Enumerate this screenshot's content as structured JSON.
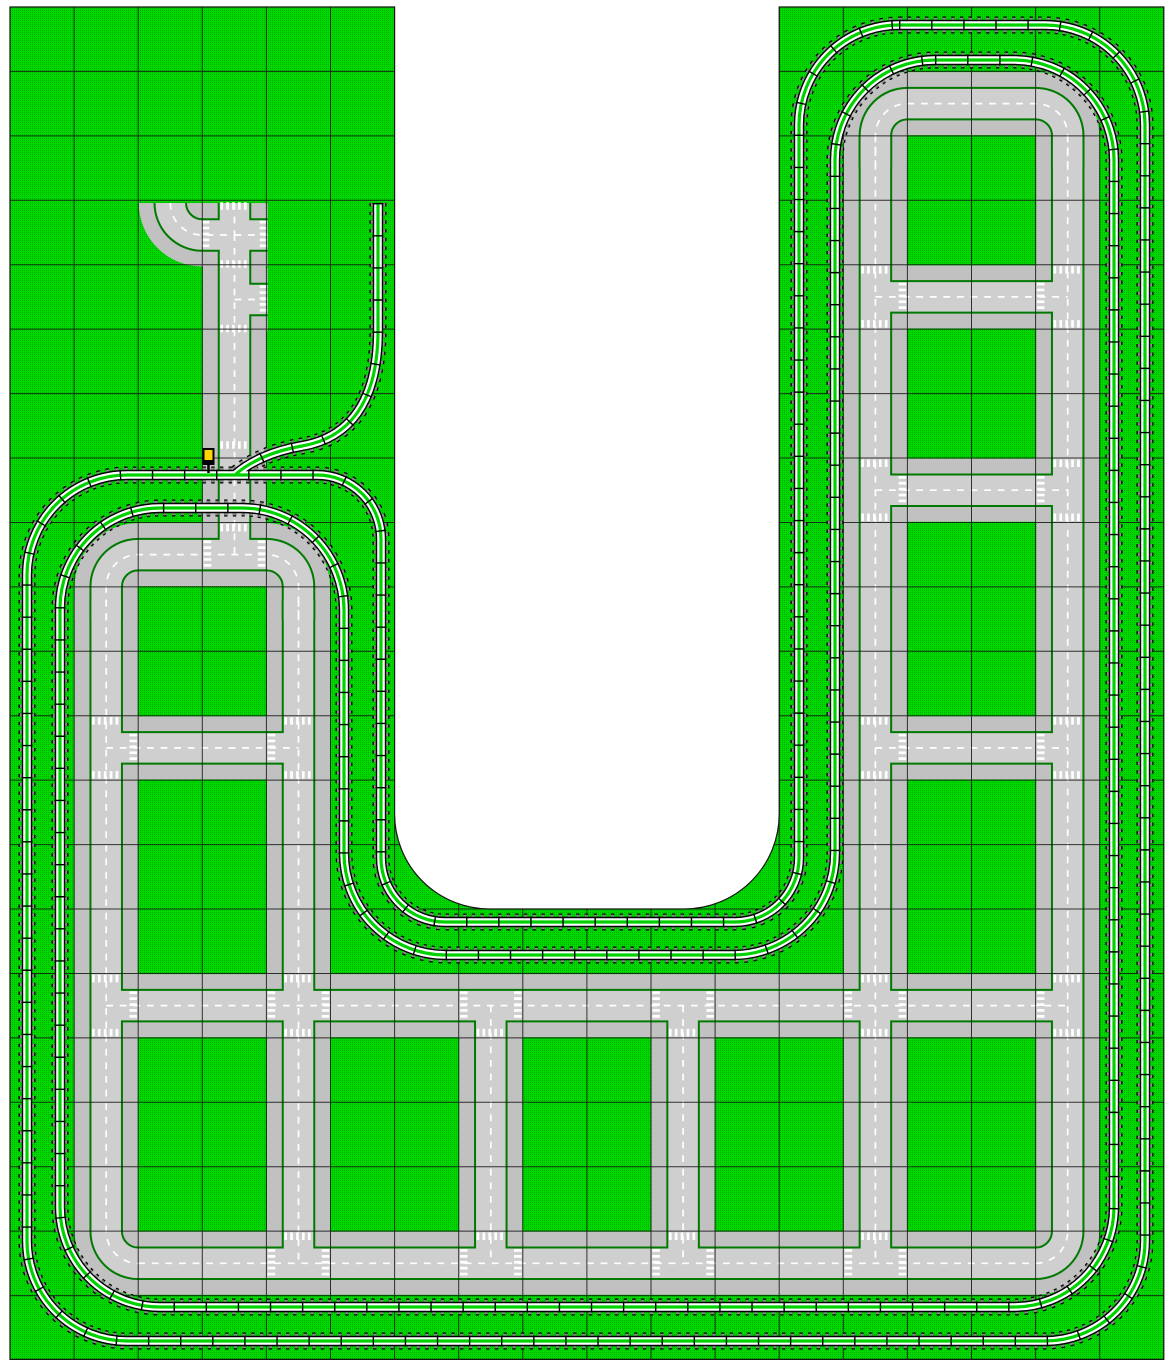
{
  "canvas": {
    "width": 1176,
    "height": 1368,
    "background": "#FFFFFF"
  },
  "layout": {
    "grid": {
      "x0": 10,
      "y0": 7,
      "cw": 64.1,
      "ch": 64.43,
      "cols": 18,
      "rows": 21,
      "color": "#151515"
    },
    "baseplates": {
      "color": "#00DA00",
      "stud_color": "#00B000",
      "edge_color": "#151515",
      "outline_path": "M10,7 H394.6 V814 A95 95 0 0 0 489.6,909 H684.2 A95 95 0 0 0 779.2,814 V7 H1163.8 V1359.4 H10 Z"
    },
    "roads": {
      "style": {
        "plate": {
          "c": "#C1C1C1",
          "w": 63
        },
        "curb": {
          "c": "#007A00",
          "w": 33.5
        },
        "asphalt": {
          "c": "#CFCFCF",
          "w": 29.5
        },
        "center": {
          "c": "#FFFFFF",
          "w": 1.7,
          "dash": "6.8 6.8"
        }
      },
      "segments": [
        {
          "name": "col3-street",
          "d": "M170.3,203 A32 32 0 0 0 202.3,235 H234.5 V554.6"
        },
        {
          "name": "col3-north-stub",
          "d": "M234.5,203 V235"
        },
        {
          "name": "col3-east-stub-1",
          "d": "M234.5,235 H267.6"
        },
        {
          "name": "col3-east-stub-2",
          "d": "M234.5,299.5 H267.6"
        },
        {
          "name": "left-ring-top",
          "d": "M106.2,620 V586.6 A32 32 0 0 1 138.2,554.6 H266.5 A32 32 0 0 1 298.5,586.6 V620"
        },
        {
          "name": "col1-avenue",
          "d": "M106.2,600 V1231.3 A32 32 0 0 0 138.2,1263.3"
        },
        {
          "name": "col4-avenue",
          "d": "M298.5,600 V1263.3"
        },
        {
          "name": "left-rung-11",
          "d": "M106.2,747.9 H298.5"
        },
        {
          "name": "main-street-15",
          "d": "M106.2,1005.6 H1067.7"
        },
        {
          "name": "south-street-19",
          "d": "M138.2,1263.3 H1035.7 A32 32 0 0 0 1067.7,1231.3"
        },
        {
          "name": "col7-connector",
          "d": "M490.8,1005.6 V1263.3"
        },
        {
          "name": "col10-connector",
          "d": "M683.1,1005.6 V1263.3"
        },
        {
          "name": "col13-avenue",
          "d": "M875.4,135.7 V1263.3"
        },
        {
          "name": "col16-avenue",
          "d": "M1067.7,135.7 V1231.3"
        },
        {
          "name": "right-ring-top",
          "d": "M875.4,167 V135.7 A32 32 0 0 1 907.4,103.6 H1035.7 A32 32 0 0 1 1067.7,135.7 V167"
        },
        {
          "name": "right-rung-4",
          "d": "M875.4,296.9 H1067.7"
        },
        {
          "name": "right-rung-7",
          "d": "M875.4,490.2 H1067.7"
        },
        {
          "name": "right-rung-11",
          "d": "M875.4,747.9 H1067.7"
        }
      ],
      "crosswalk_style": {
        "c": "#FFFFFF",
        "w": 7.5,
        "dash": "2.7 3.2",
        "half": 14.2
      },
      "crosswalks": [
        [
          234.5,
          206,
          "h"
        ],
        [
          263.5,
          235,
          "v"
        ],
        [
          234.5,
          264,
          "h"
        ],
        [
          205.5,
          235,
          "v"
        ],
        [
          263.5,
          299.5,
          "v"
        ],
        [
          234.5,
          328.5,
          "h"
        ],
        [
          234.5,
          445,
          "h"
        ],
        [
          234.5,
          527.6,
          "h"
        ],
        [
          207.5,
          554.6,
          "v"
        ],
        [
          261.5,
          554.6,
          "v"
        ],
        [
          106.2,
          720.9,
          "h"
        ],
        [
          106.2,
          774.9,
          "h"
        ],
        [
          133.2,
          747.9,
          "v"
        ],
        [
          298.5,
          720.9,
          "h"
        ],
        [
          298.5,
          774.9,
          "h"
        ],
        [
          271.5,
          747.9,
          "v"
        ],
        [
          106.2,
          978.6,
          "h"
        ],
        [
          106.2,
          1032.6,
          "h"
        ],
        [
          133.2,
          1005.6,
          "v"
        ],
        [
          298.5,
          978.6,
          "h"
        ],
        [
          298.5,
          1032.6,
          "h"
        ],
        [
          271.5,
          1005.6,
          "v"
        ],
        [
          325.5,
          1005.6,
          "v"
        ],
        [
          490.8,
          1032.6,
          "h"
        ],
        [
          463.8,
          1005.6,
          "v"
        ],
        [
          517.8,
          1005.6,
          "v"
        ],
        [
          683.1,
          1032.6,
          "h"
        ],
        [
          656.1,
          1005.6,
          "v"
        ],
        [
          710.1,
          1005.6,
          "v"
        ],
        [
          875.4,
          978.6,
          "h"
        ],
        [
          875.4,
          1032.6,
          "h"
        ],
        [
          848.4,
          1005.6,
          "v"
        ],
        [
          902.4,
          1005.6,
          "v"
        ],
        [
          1067.7,
          978.6,
          "h"
        ],
        [
          1067.7,
          1032.6,
          "h"
        ],
        [
          1040.7,
          1005.6,
          "v"
        ],
        [
          298.5,
          1236.3,
          "h"
        ],
        [
          271.5,
          1263.3,
          "v"
        ],
        [
          325.5,
          1263.3,
          "v"
        ],
        [
          490.8,
          1236.3,
          "h"
        ],
        [
          463.8,
          1263.3,
          "v"
        ],
        [
          517.8,
          1263.3,
          "v"
        ],
        [
          683.1,
          1236.3,
          "h"
        ],
        [
          656.1,
          1263.3,
          "v"
        ],
        [
          710.1,
          1263.3,
          "v"
        ],
        [
          875.4,
          1236.3,
          "h"
        ],
        [
          848.4,
          1263.3,
          "v"
        ],
        [
          902.4,
          1263.3,
          "v"
        ],
        [
          875.4,
          269.9,
          "h"
        ],
        [
          875.4,
          323.9,
          "h"
        ],
        [
          902.4,
          296.9,
          "v"
        ],
        [
          1067.7,
          269.9,
          "h"
        ],
        [
          1067.7,
          323.9,
          "h"
        ],
        [
          1040.7,
          296.9,
          "v"
        ],
        [
          875.4,
          463.2,
          "h"
        ],
        [
          875.4,
          517.2,
          "h"
        ],
        [
          902.4,
          490.2,
          "v"
        ],
        [
          1067.7,
          463.2,
          "h"
        ],
        [
          1067.7,
          517.2,
          "h"
        ],
        [
          1040.7,
          490.2,
          "v"
        ],
        [
          875.4,
          720.9,
          "h"
        ],
        [
          875.4,
          774.9,
          "h"
        ],
        [
          902.4,
          747.9,
          "v"
        ],
        [
          1067.7,
          720.9,
          "h"
        ],
        [
          1067.7,
          774.9,
          "h"
        ],
        [
          1040.7,
          747.9,
          "v"
        ]
      ]
    },
    "tracks": {
      "layers": [
        {
          "c": "#000000",
          "w": 17,
          "dash": "3.4 5.3"
        },
        {
          "c": "#8B8B8B",
          "w": 14.4,
          "dash": "3.4 5.3"
        },
        {
          "c": "#000000",
          "w": 10.4
        },
        {
          "c": "#FFFFFF",
          "w": 7.6
        },
        {
          "c": "#00D200",
          "w": 3.2
        },
        {
          "c": "#000000",
          "w": 11,
          "dash": "1.4 30.7"
        }
      ],
      "segments": [
        {
          "name": "outer-loop",
          "d": "M899,25 H1045 A100 100 0 0 1 1145,125 V1241 A100 100 0 0 1 1045,1341 H127 A100 100 0 0 1 27,1241 V575 A100 100 0 0 1 127,475 H317 A64 64 0 0 1 381,539 V858 A64 64 0 0 0 445,922 H735 A64 64 0 0 0 799,858 V125 A100 100 0 0 1 899,25 Z"
        },
        {
          "name": "inner-loop",
          "d": "M935,60 H1014 A100 100 0 0 1 1114,160 V1207 A100 100 0 0 1 1014,1307 H160 A100 100 0 0 1 60,1207 V608 A100 100 0 0 1 160,508 H242 A102 102 0 0 1 344,610 V853 A102 102 0 0 0 446,955 H733 A102 102 0 0 0 835,853 V160 A100 100 0 0 1 935,60 Z"
        },
        {
          "name": "siding",
          "d": "M378,203 V330 C378,404 348,438 302,446 C272,451 250,462 236,474"
        }
      ]
    },
    "signal": {
      "body": {
        "x": 202.5,
        "y": 448,
        "w": 12,
        "h": 17,
        "c": "#000000"
      },
      "lamp": {
        "x": 204.5,
        "y": 450,
        "w": 8,
        "h": 10,
        "c": "#FFD500"
      },
      "post": {
        "x": 208.5,
        "y1": 465,
        "y2": 473,
        "c": "#000000"
      }
    }
  }
}
